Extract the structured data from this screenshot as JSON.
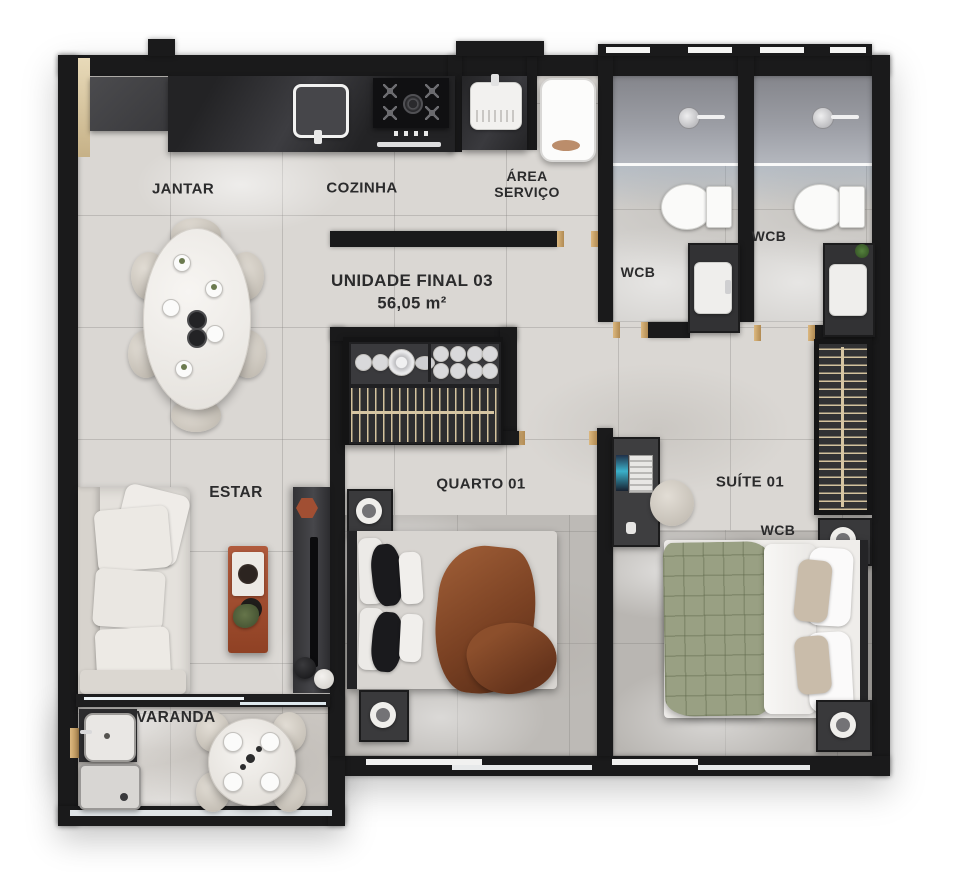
{
  "unit": {
    "name": "UNIDADE FINAL 03",
    "area": "56,05 m²"
  },
  "rooms": {
    "jantar": {
      "label": "JANTAR"
    },
    "cozinha": {
      "label": "COZINHA"
    },
    "area_servico": {
      "label": "ÁREA SERVIÇO"
    },
    "wcb1": {
      "label": "WCB"
    },
    "wcb2": {
      "label": "WCB"
    },
    "quarto": {
      "label": "QUARTO 01"
    },
    "suite": {
      "label": "SUÍTE 01"
    },
    "suite_wcb": {
      "label": "WCB"
    },
    "estar": {
      "label": "ESTAR"
    },
    "varanda": {
      "label": "VARANDA"
    }
  },
  "colors": {
    "wall": "#1a1a1b",
    "floor_light": "#dad7d3",
    "floor_varanda": "#ccc8c3",
    "rug_gray": "#bdbab6",
    "shower_gray": "#8e9096",
    "counter_dark": "#28282a",
    "accent_rust": "#a85436",
    "wood_gold": "#c8a671",
    "sofa_cream": "#e4e1dc",
    "blanket_green": "#99a083",
    "throw_brown": "#8a4a2c",
    "label_text": "#2b2b2c"
  }
}
